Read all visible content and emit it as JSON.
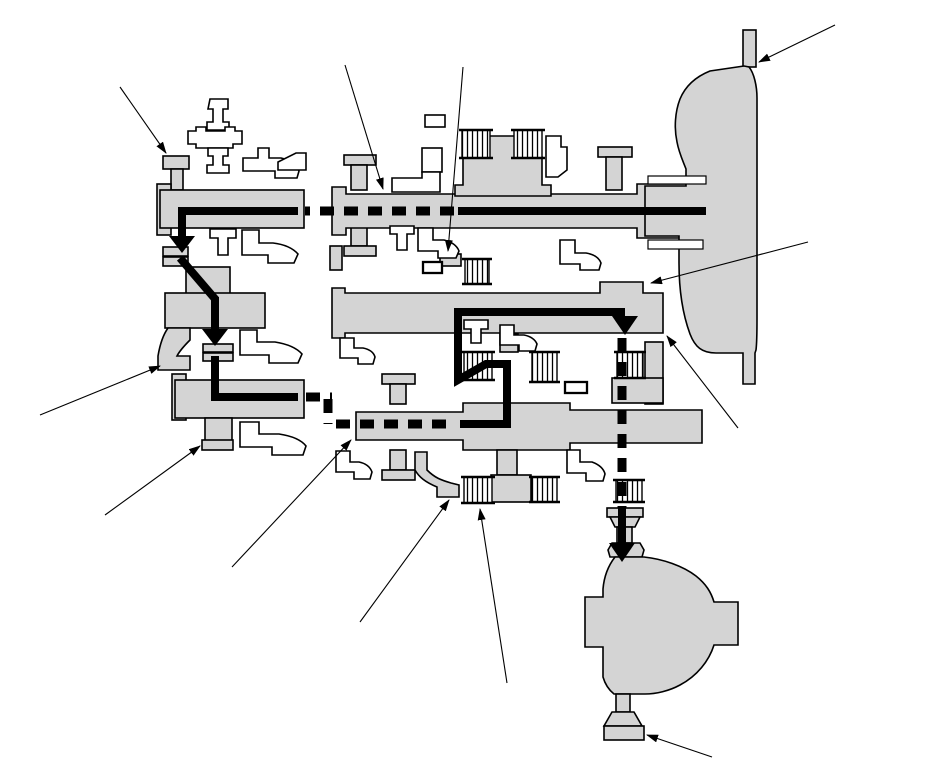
{
  "diagram": {
    "kind": "transmission-power-flow-cross-section",
    "visible_text": "",
    "callout_arrow_count": 12,
    "clutch_pack_count": 9
  },
  "colors": {
    "background": "#ffffff",
    "component_fill": "#d4d4d4",
    "outline": "#000000",
    "power_flow": "#000000",
    "callout": "#000000"
  },
  "components": {
    "left_cluster": "auxiliary-gear-cluster",
    "main_cluster": "main-gear-train",
    "torque_converter": "torque-converter-housing",
    "differential": "final-drive-differential",
    "power_flow": "power-flow-path",
    "clutch_pack": "multi-plate-clutch-pack",
    "synchro": "synchronizer-rings",
    "callout": "component-pointer-arrow"
  }
}
